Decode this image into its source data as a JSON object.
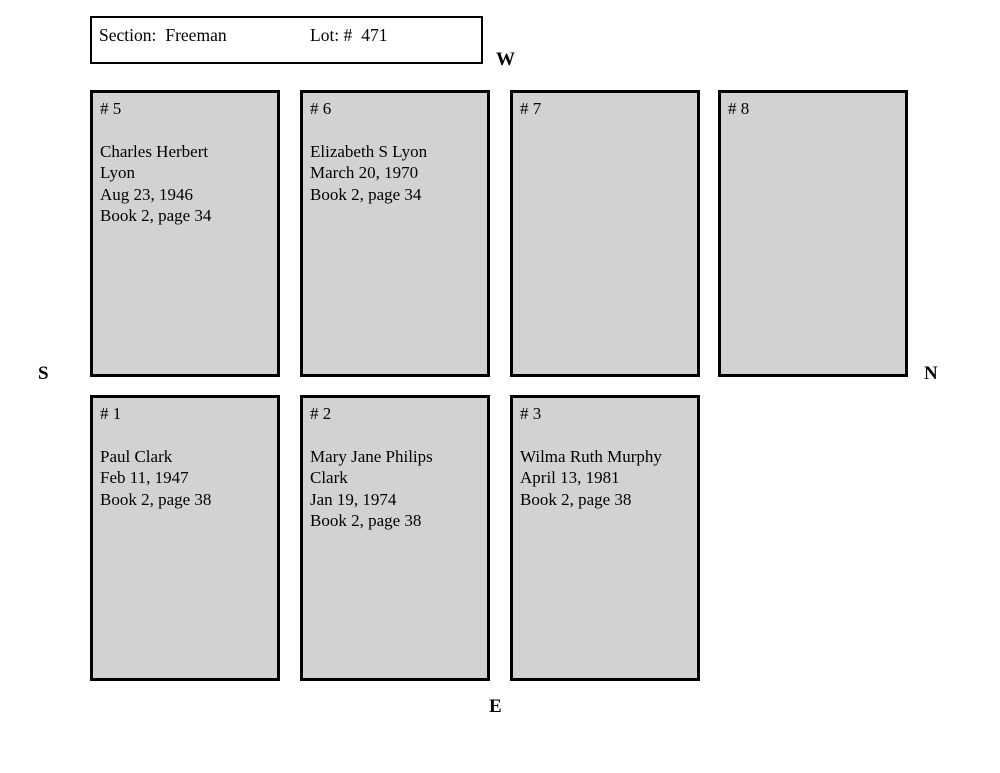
{
  "header": {
    "section_label": "Section:",
    "section_value": "Freeman",
    "lot_label": "Lot: #",
    "lot_value": "471"
  },
  "compass": {
    "west": "W",
    "south": "S",
    "north": "N",
    "east": "E"
  },
  "rows": {
    "top": [
      {
        "id": "5",
        "number": "# 5",
        "lines": [
          "Charles Herbert",
          "Lyon",
          "Aug 23, 1946",
          "Book 2, page 34"
        ]
      },
      {
        "id": "6",
        "number": "# 6",
        "lines": [
          "Elizabeth S Lyon",
          "March 20, 1970",
          "Book 2, page 34"
        ]
      },
      {
        "id": "7",
        "number": "# 7",
        "lines": []
      },
      {
        "id": "8",
        "number": "# 8",
        "lines": []
      }
    ],
    "bottom": [
      {
        "id": "1",
        "number": "# 1",
        "lines": [
          "Paul Clark",
          "Feb 11, 1947",
          "Book 2, page 38"
        ]
      },
      {
        "id": "2",
        "number": "# 2",
        "lines": [
          "Mary Jane Philips",
          "Clark",
          "Jan 19, 1974",
          "Book 2, page 38"
        ]
      },
      {
        "id": "3",
        "number": "# 3",
        "lines": [
          "Wilma Ruth Murphy",
          "April 13, 1981",
          "Book 2, page 38"
        ]
      }
    ]
  },
  "colors": {
    "plot_fill": "#d2d2d2",
    "plot_border": "#000000",
    "background": "#ffffff",
    "text": "#000000"
  }
}
